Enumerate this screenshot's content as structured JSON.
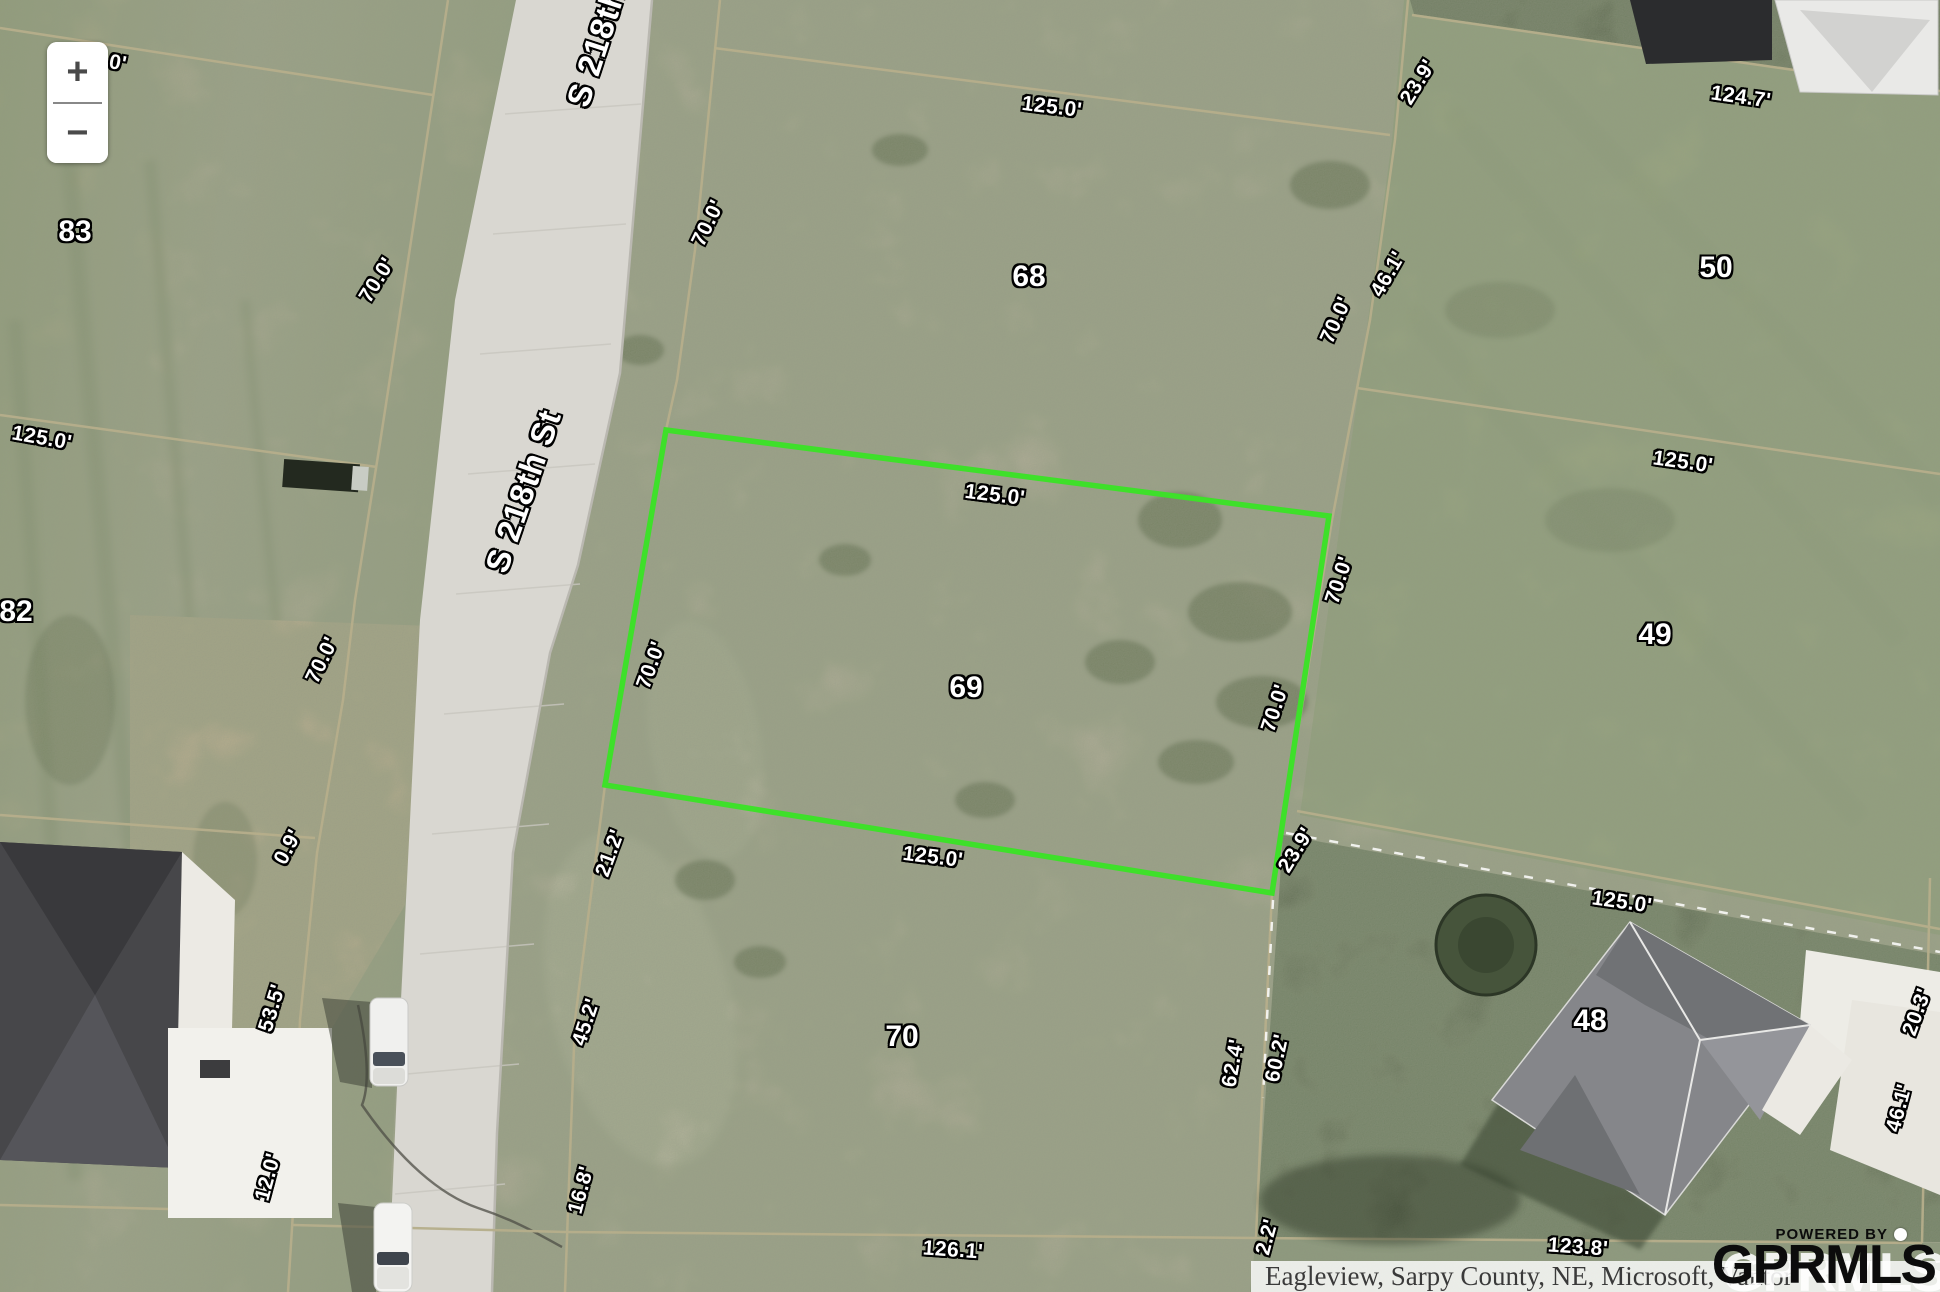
{
  "map": {
    "street_name": "S 218th St",
    "zoom_controls": {
      "zoom_in": "+",
      "zoom_out": "−"
    },
    "highlight": {
      "lot": "69",
      "color": "#3ee02a",
      "points": "666,430 1329,516 1272,893 605,785"
    },
    "labels": [
      {
        "text": "0'",
        "x": 118,
        "y": 63,
        "rot": 10,
        "kind": "dim"
      },
      {
        "text": "83",
        "x": 75,
        "y": 232,
        "rot": 0,
        "kind": "lot"
      },
      {
        "text": "70.0'",
        "x": 377,
        "y": 280,
        "rot": -58,
        "kind": "dim"
      },
      {
        "text": "125.0'",
        "x": 42,
        "y": 438,
        "rot": 10,
        "kind": "dim"
      },
      {
        "text": "82",
        "x": 16,
        "y": 612,
        "rot": 0,
        "kind": "lot"
      },
      {
        "text": "70.0'",
        "x": 322,
        "y": 660,
        "rot": -64,
        "kind": "dim"
      },
      {
        "text": "0.9'",
        "x": 288,
        "y": 847,
        "rot": -62,
        "kind": "dim"
      },
      {
        "text": "53.5'",
        "x": 272,
        "y": 1008,
        "rot": -73,
        "kind": "dim"
      },
      {
        "text": "12.0'",
        "x": 268,
        "y": 1177,
        "rot": -75,
        "kind": "dim"
      },
      {
        "text": "S 218th St",
        "x": 603,
        "y": 25,
        "rot": -72,
        "kind": "street"
      },
      {
        "text": "S 218th St",
        "x": 523,
        "y": 491,
        "rot": -71,
        "kind": "street"
      },
      {
        "text": "70.0'",
        "x": 708,
        "y": 223,
        "rot": -64,
        "kind": "dim"
      },
      {
        "text": "125.0'",
        "x": 1052,
        "y": 107,
        "rot": 7,
        "kind": "dim"
      },
      {
        "text": "68",
        "x": 1029,
        "y": 277,
        "rot": 0,
        "kind": "lot"
      },
      {
        "text": "23.9'",
        "x": 1418,
        "y": 82,
        "rot": -58,
        "kind": "dim"
      },
      {
        "text": "46.1'",
        "x": 1388,
        "y": 274,
        "rot": -60,
        "kind": "dim"
      },
      {
        "text": "70.0'",
        "x": 1336,
        "y": 320,
        "rot": -66,
        "kind": "dim"
      },
      {
        "text": "124.7'",
        "x": 1741,
        "y": 97,
        "rot": 8,
        "kind": "dim"
      },
      {
        "text": "50",
        "x": 1716,
        "y": 268,
        "rot": 0,
        "kind": "lot"
      },
      {
        "text": "125.0'",
        "x": 995,
        "y": 495,
        "rot": 7,
        "kind": "dim"
      },
      {
        "text": "70.0'",
        "x": 651,
        "y": 665,
        "rot": -70,
        "kind": "dim"
      },
      {
        "text": "69",
        "x": 966,
        "y": 688,
        "rot": 0,
        "kind": "lot"
      },
      {
        "text": "70.0'",
        "x": 1339,
        "y": 580,
        "rot": -72,
        "kind": "dim"
      },
      {
        "text": "70.0'",
        "x": 1275,
        "y": 708,
        "rot": -72,
        "kind": "dim"
      },
      {
        "text": "125.0'",
        "x": 1683,
        "y": 462,
        "rot": 8,
        "kind": "dim"
      },
      {
        "text": "49",
        "x": 1655,
        "y": 635,
        "rot": 0,
        "kind": "lot"
      },
      {
        "text": "125.0'",
        "x": 933,
        "y": 857,
        "rot": 7,
        "kind": "dim"
      },
      {
        "text": "21.2'",
        "x": 610,
        "y": 853,
        "rot": -70,
        "kind": "dim"
      },
      {
        "text": "45.2'",
        "x": 586,
        "y": 1022,
        "rot": -72,
        "kind": "dim"
      },
      {
        "text": "16.8'",
        "x": 581,
        "y": 1190,
        "rot": -75,
        "kind": "dim"
      },
      {
        "text": "70",
        "x": 902,
        "y": 1037,
        "rot": 0,
        "kind": "lot"
      },
      {
        "text": "126.1'",
        "x": 953,
        "y": 1250,
        "rot": 4,
        "kind": "dim"
      },
      {
        "text": "23.9'",
        "x": 1296,
        "y": 850,
        "rot": -58,
        "kind": "dim"
      },
      {
        "text": "62.4'",
        "x": 1233,
        "y": 1063,
        "rot": -80,
        "kind": "dim"
      },
      {
        "text": "60.2'",
        "x": 1277,
        "y": 1058,
        "rot": -78,
        "kind": "dim"
      },
      {
        "text": "2.2'",
        "x": 1267,
        "y": 1237,
        "rot": -75,
        "kind": "dim"
      },
      {
        "text": "125.0'",
        "x": 1622,
        "y": 902,
        "rot": 8,
        "kind": "dim"
      },
      {
        "text": "48",
        "x": 1590,
        "y": 1021,
        "rot": 0,
        "kind": "lot"
      },
      {
        "text": "20.3'",
        "x": 1917,
        "y": 1012,
        "rot": -70,
        "kind": "dim"
      },
      {
        "text": "46.1'",
        "x": 1899,
        "y": 1108,
        "rot": -75,
        "kind": "dim"
      },
      {
        "text": "123.8'",
        "x": 1578,
        "y": 1247,
        "rot": 4,
        "kind": "dim"
      }
    ]
  },
  "attribution": {
    "text": "Eagleview, Sarpy County, NE, Microsoft, Vantor"
  },
  "branding": {
    "powered_by": "POWERED BY",
    "logo": "GPRMLS"
  }
}
